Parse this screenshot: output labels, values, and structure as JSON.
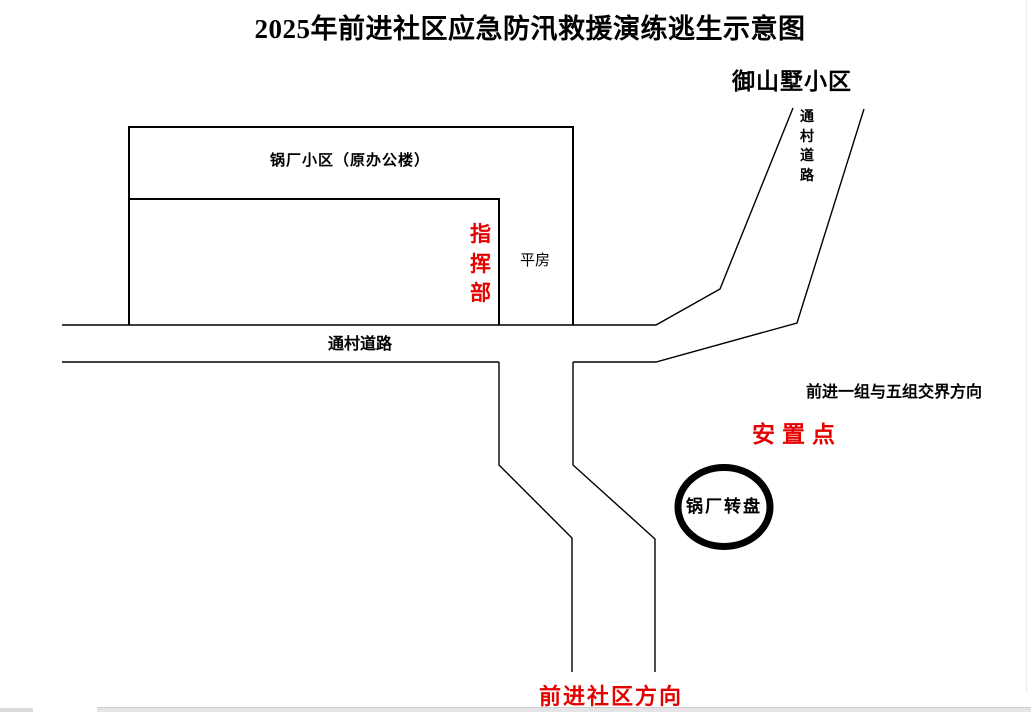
{
  "title": "2025年前进社区应急防汛救援演练逃生示意图",
  "colors": {
    "accent_red": "#e60000",
    "line_black": "#000000",
    "bottom_bar_gray": "#e4e4e7"
  },
  "map": {
    "yushanshu_label": "御山墅小区",
    "village_road_vertical_label": "通村道路",
    "guochang_block_label": "锅厂小区（原办公楼）",
    "command_post_label": "指挥部",
    "bungalow_label": "平房",
    "village_road_label": "通村道路",
    "boundary_direction_label": "前进一组与五组交界方向",
    "resettlement_label": "安置点",
    "roundabout_label": "锅厂转盘",
    "qianjin_direction_label": "前进社区方向"
  }
}
